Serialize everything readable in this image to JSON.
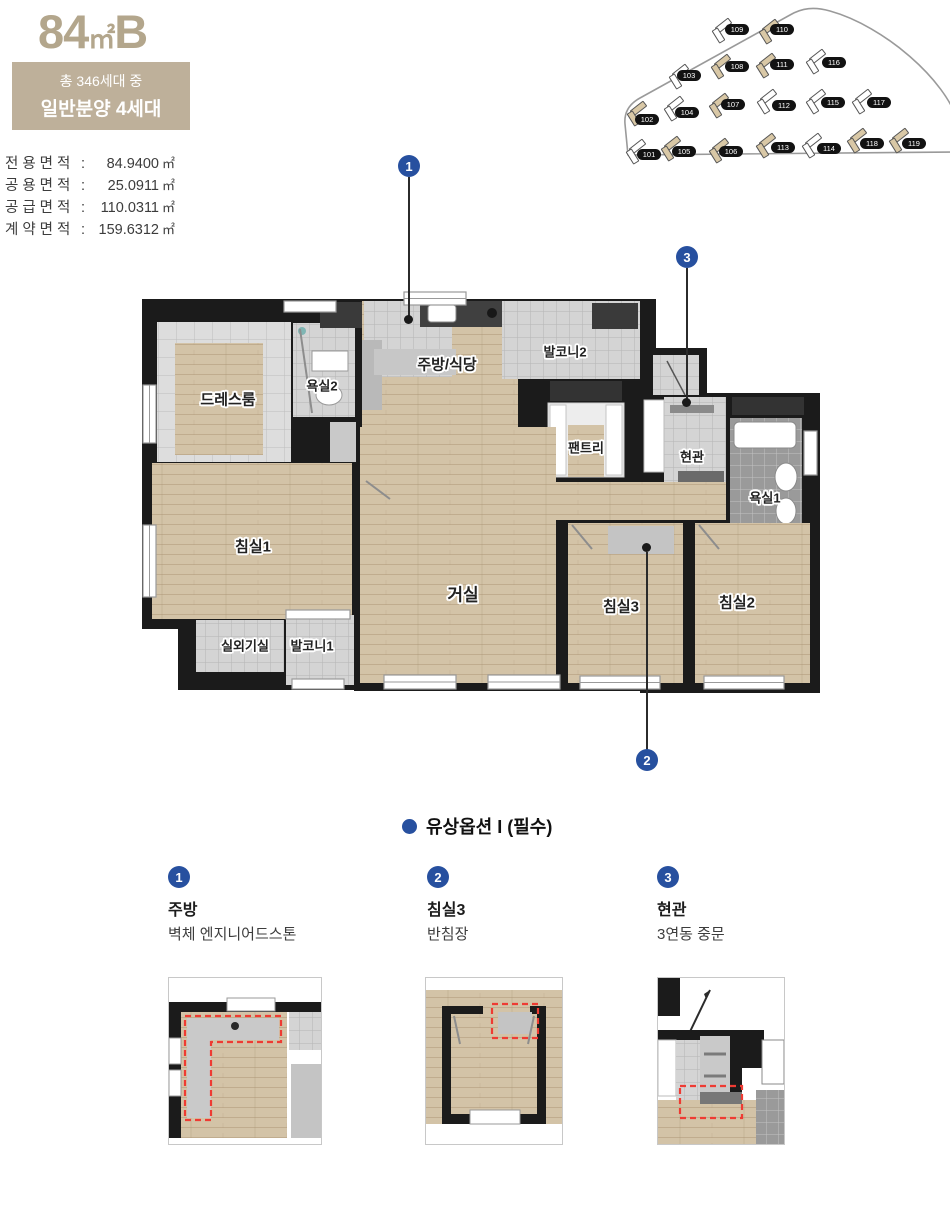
{
  "header": {
    "title": {
      "main": "84",
      "unit": "㎡",
      "suffix": "B"
    },
    "badge": {
      "line1": "총 346세대 중",
      "line2": "일반분양 4세대"
    },
    "areas": [
      {
        "label": "전용면적",
        "value": "84.9400",
        "unit": "㎡"
      },
      {
        "label": "공용면적",
        "value": "25.0911",
        "unit": "㎡"
      },
      {
        "label": "공급면적",
        "value": "110.0311",
        "unit": "㎡"
      },
      {
        "label": "계약면적",
        "value": "159.6312",
        "unit": "㎡"
      }
    ]
  },
  "site_plan": {
    "buildings": [
      {
        "no": "101",
        "highlight": false
      },
      {
        "no": "102",
        "highlight": true
      },
      {
        "no": "103",
        "highlight": false
      },
      {
        "no": "104",
        "highlight": false
      },
      {
        "no": "105",
        "highlight": true
      },
      {
        "no": "106",
        "highlight": true
      },
      {
        "no": "107",
        "highlight": true
      },
      {
        "no": "108",
        "highlight": true
      },
      {
        "no": "109",
        "highlight": false
      },
      {
        "no": "110",
        "highlight": true
      },
      {
        "no": "111",
        "highlight": true
      },
      {
        "no": "112",
        "highlight": false
      },
      {
        "no": "113",
        "highlight": true
      },
      {
        "no": "114",
        "highlight": false
      },
      {
        "no": "115",
        "highlight": false
      },
      {
        "no": "116",
        "highlight": false
      },
      {
        "no": "117",
        "highlight": false
      },
      {
        "no": "118",
        "highlight": true
      },
      {
        "no": "119",
        "highlight": true
      }
    ]
  },
  "floor_plan": {
    "rooms": {
      "dressroom": "드레스룸",
      "bath2": "욕실2",
      "kitchen": "주방/식당",
      "balcony2": "발코니2",
      "pantry": "팬트리",
      "entrance": "현관",
      "bath1": "욕실1",
      "bedroom1": "침실1",
      "living": "거실",
      "bedroom3": "침실3",
      "bedroom2": "침실2",
      "outdoor_unit": "실외기실",
      "balcony1": "발코니1"
    },
    "markers": [
      "1",
      "2",
      "3"
    ]
  },
  "options_section": {
    "title": "유상옵션 I (필수)",
    "options": [
      {
        "num": "1",
        "title": "주방",
        "desc": "벽체 엔지니어드스톤"
      },
      {
        "num": "2",
        "title": "침실3",
        "desc": "반침장"
      },
      {
        "num": "3",
        "title": "현관",
        "desc": "3연동 중문"
      }
    ]
  },
  "colors": {
    "beige": "#b3a68c",
    "badge_bg": "#beb09a",
    "accent_blue": "#27509f",
    "wall": "#1b1b1b",
    "wood": "#d3c3a7",
    "option_red": "#ee3b33"
  }
}
